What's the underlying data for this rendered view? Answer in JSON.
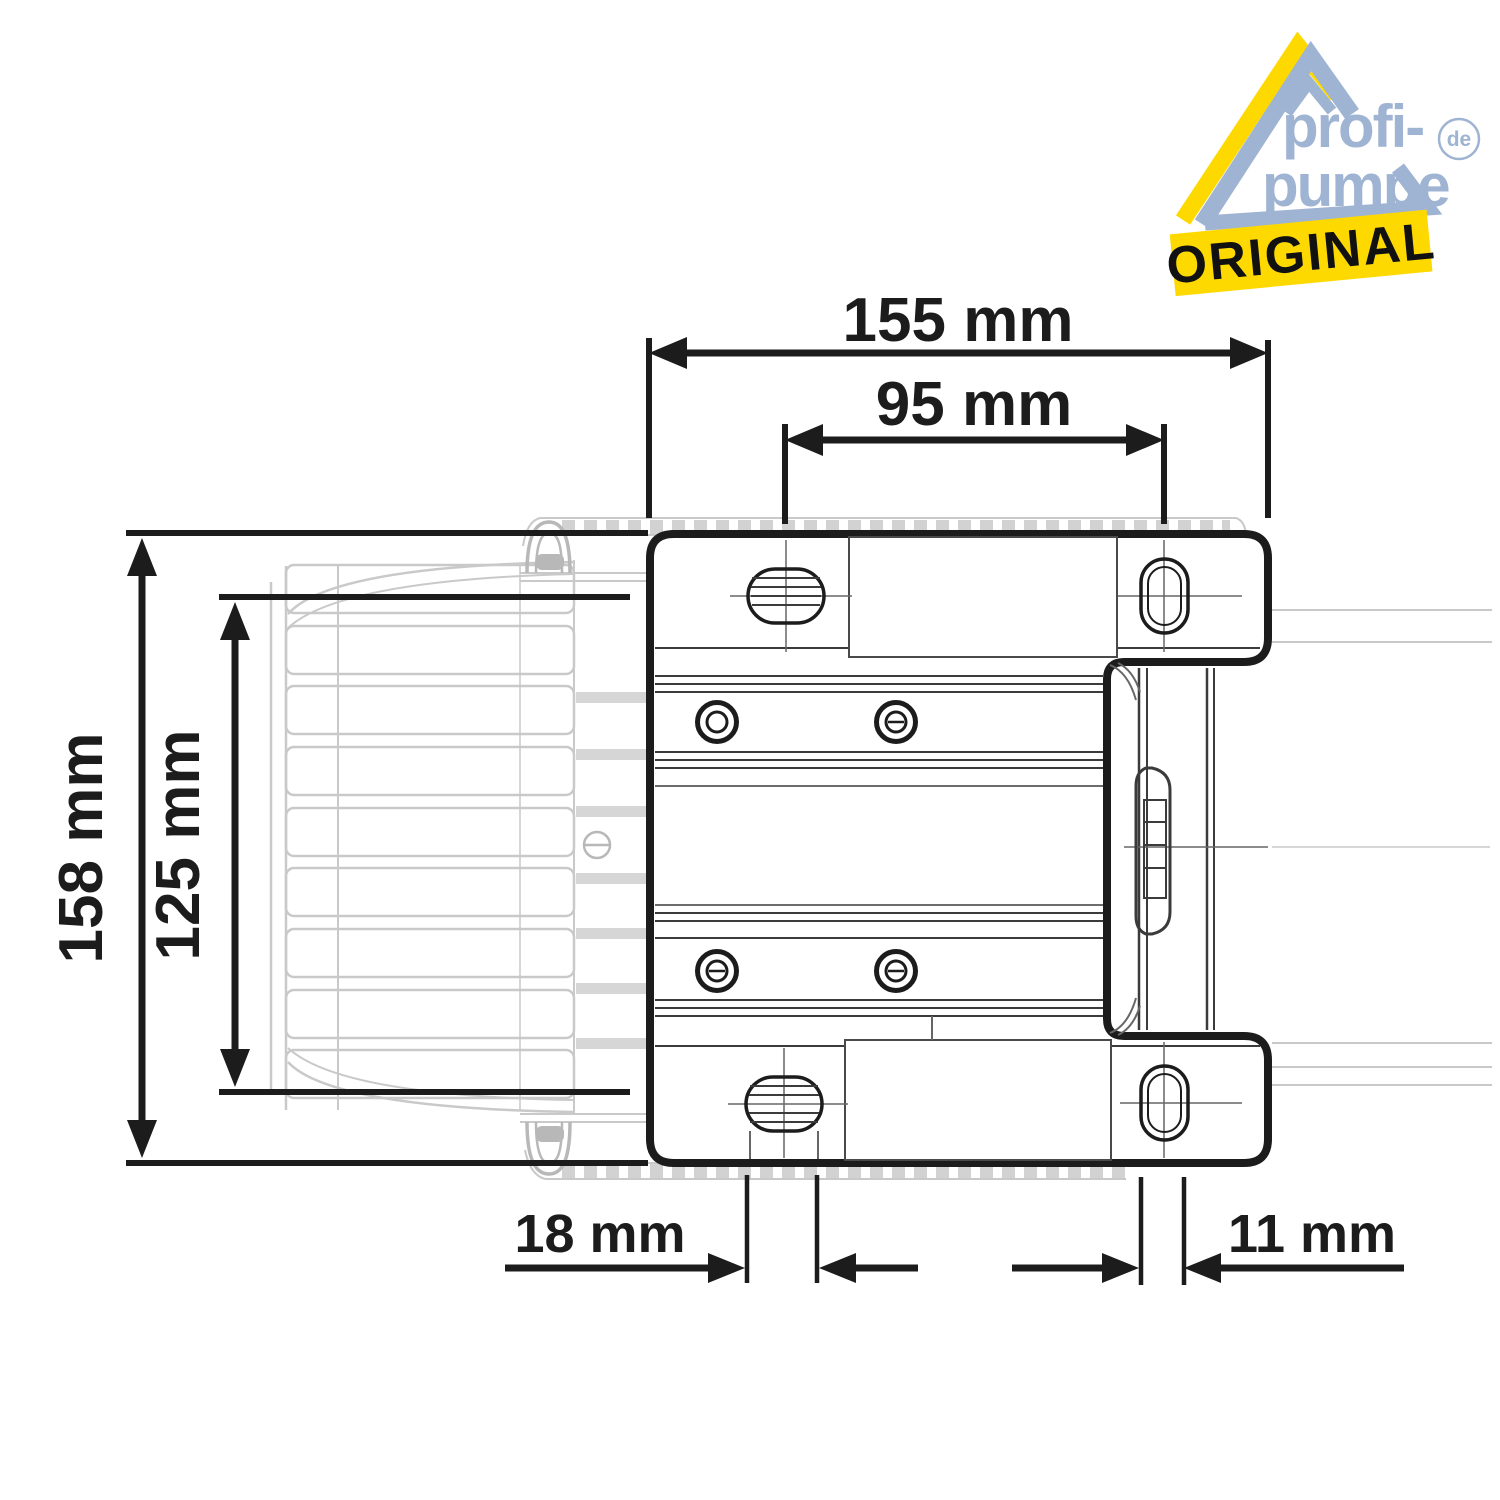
{
  "canvas": {
    "background": "#ffffff"
  },
  "logo": {
    "brand_top": "profi-",
    "brand_bottom": "pumpe",
    "domain": "de",
    "badge": "ORIGINAL",
    "colors": {
      "blue": "#9fb3d3",
      "yellow": "#fed900",
      "badge_text": "#111111"
    }
  },
  "drawing": {
    "line_color": "#1c1c1c",
    "faded_color": "#c9c9c9",
    "dimensions": {
      "width_total": {
        "label": "155 mm"
      },
      "hole_spacing": {
        "label": "95 mm"
      },
      "height_total": {
        "label": "158 mm"
      },
      "height_fins": {
        "label": "125 mm"
      },
      "slot_left_width": {
        "label": "18 mm"
      },
      "slot_right_width": {
        "label": "11 mm"
      }
    }
  }
}
